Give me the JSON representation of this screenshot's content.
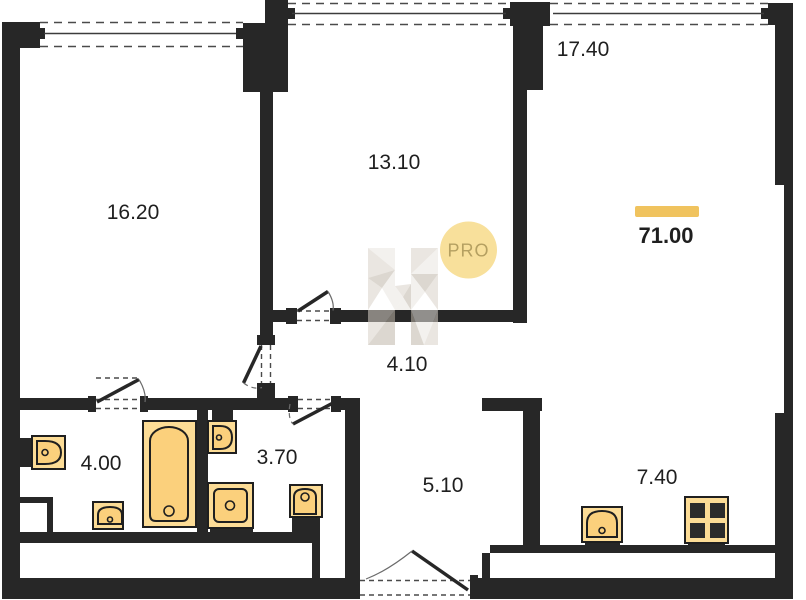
{
  "colors": {
    "wall": "#272727",
    "line": "#3c3c3c",
    "dash": "#4a4a4a",
    "fixture_outer": "#FCDC96",
    "fixture_inner": "#FBD07C",
    "fixture_stroke": "#1f1f1f",
    "burner": "#2b2b2b",
    "accent_bar": "#F0C35E",
    "badge_fill": "#F8E09B",
    "badge_text": "#B5A061",
    "label_text": "#1f1f1f",
    "wm_light": "#EAE6E0",
    "wm_mid": "#D9D2C8",
    "wm_dark": "#BFB6A9"
  },
  "badge": {
    "label": "PRO"
  },
  "watermark": {
    "letter": "H"
  },
  "total_area": {
    "value": "71.00"
  },
  "rooms": [
    {
      "name": "room-16-20",
      "area": "16.20"
    },
    {
      "name": "room-13-10",
      "area": "13.10"
    },
    {
      "name": "room-17-40",
      "area": "17.40"
    },
    {
      "name": "hallway-4-10",
      "area": "4.10"
    },
    {
      "name": "bathroom-4-00",
      "area": "4.00"
    },
    {
      "name": "bathroom-3-70",
      "area": "3.70"
    },
    {
      "name": "hallway-5-10",
      "area": "5.10"
    },
    {
      "name": "kitchen-7-40",
      "area": "7.40"
    }
  ],
  "fixtures": [
    "toilet-symbol",
    "sink-symbol",
    "bathtub-symbol",
    "washing-machine-symbol",
    "toilet-symbol",
    "sink-symbol",
    "kitchen-sink-symbol",
    "stove-symbol"
  ]
}
